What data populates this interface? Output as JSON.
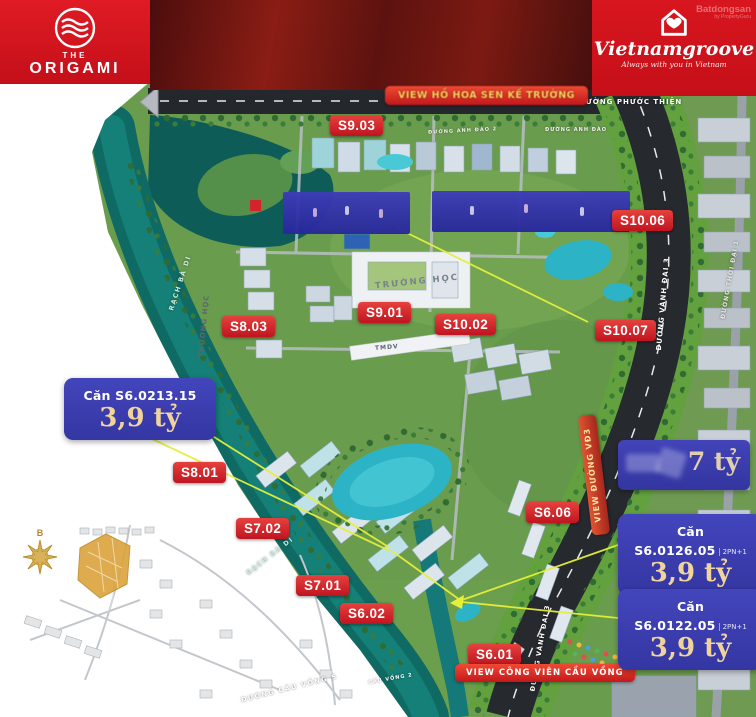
{
  "branding": {
    "origami": {
      "prefix": "THE",
      "name": "ORIGAMI"
    },
    "agency": {
      "name": "Vietnamgroove",
      "tagline": "Always with you in Vietnam",
      "watermark": "Batdongsan",
      "watermark_sub": "by PropertyGuru"
    }
  },
  "banners": {
    "top_view": "VIEW HỒ HOA SEN KẾ TRƯỜNG",
    "rainbow_view": "VIEW CÔNG VIÊN CẦU VỒNG",
    "highway_view": "VIEW ĐƯỜNG VĐ3"
  },
  "map": {
    "building_labels": [
      "S9.03",
      "S10.06",
      "S8.03",
      "S9.01",
      "S10.02",
      "S10.07",
      "S8.01",
      "S7.02",
      "S7.01",
      "S6.02",
      "S6.06",
      "S6.01"
    ],
    "roads": {
      "phuoc_thien": "ĐƯỜNG PHƯỚC THIỆN",
      "anh_dao_2": "ĐƯỜNG ANH ĐÀO 2",
      "anh_dao": "ĐƯỜNG ANH ĐÀO",
      "vanh_dai_3": "ĐƯỜNG VÀNH ĐAI 3",
      "thoi_dai_1": "ĐƯỜNG THỜI ĐẠI 1",
      "cau_vong_5": "ĐƯỜNG CẦU VỒNG 5",
      "cau_vong_2": "CẦU VỒNG 2"
    },
    "waterway": "RẠCH BÀ DI",
    "school": "TRƯỜNG HỌC",
    "commercial": "TMDV",
    "compass_north": "B"
  },
  "callouts": {
    "left": {
      "unit": "Căn S6.0213.15",
      "price": "3,9 tỷ"
    },
    "faded": {
      "price": "7 tỷ"
    },
    "right_top": {
      "unit": "Căn S6.0126.05",
      "type": "2PN+1",
      "price": "3,9 tỷ"
    },
    "right_bottom": {
      "unit": "Căn S6.0122.05",
      "type": "2PN+1",
      "price": "3,9 tỷ"
    }
  },
  "colors": {
    "brand_red": "#d21a22",
    "label_red": "#d0151f",
    "callout_blue": "#3b3fae",
    "price_cream": "#f0d49c",
    "pointer_yellow": "#e6ef3a",
    "water_teal": "#0e6a63",
    "pool_aqua": "#2cb4c6",
    "minimap_orange": "#dba43c"
  }
}
